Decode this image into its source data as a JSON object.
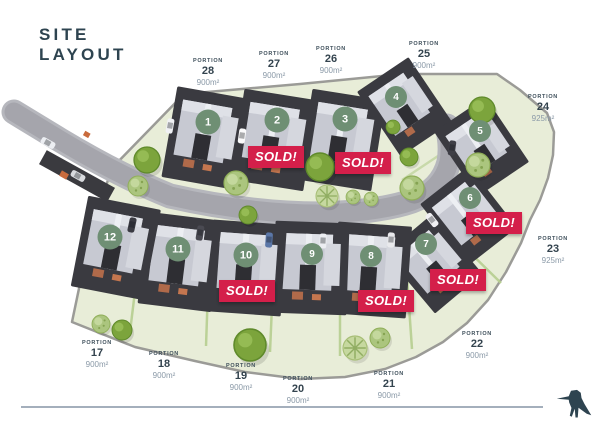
{
  "title": {
    "line1": "SITE",
    "line2": "LAYOUT"
  },
  "map": {
    "portions": [
      {
        "label": "PORTION",
        "number": "17",
        "area": "900m²"
      },
      {
        "label": "PORTION",
        "number": "18",
        "area": "900m²"
      },
      {
        "label": "PORTION",
        "number": "19",
        "area": "900m²"
      },
      {
        "label": "PORTION",
        "number": "20",
        "area": "900m²"
      },
      {
        "label": "PORTION",
        "number": "21",
        "area": "900m²"
      },
      {
        "label": "PORTION",
        "number": "22",
        "area": "900m²"
      },
      {
        "label": "PORTION",
        "number": "23",
        "area": "925m²"
      },
      {
        "label": "PORTION",
        "number": "24",
        "area": "925m²"
      },
      {
        "label": "PORTION",
        "number": "25",
        "area": "900m²"
      },
      {
        "label": "PORTION",
        "number": "26",
        "area": "900m²"
      },
      {
        "label": "PORTION",
        "number": "27",
        "area": "900m²"
      },
      {
        "label": "PORTION",
        "number": "28",
        "area": "900m²"
      }
    ],
    "houses": [
      {
        "number": "1"
      },
      {
        "number": "2"
      },
      {
        "number": "3"
      },
      {
        "number": "4"
      },
      {
        "number": "5"
      },
      {
        "number": "6"
      },
      {
        "number": "7"
      },
      {
        "number": "8"
      },
      {
        "number": "9"
      },
      {
        "number": "10"
      },
      {
        "number": "11"
      },
      {
        "number": "12"
      }
    ],
    "sold_banners": [
      {
        "text": "SOLD!"
      },
      {
        "text": "SOLD!"
      },
      {
        "text": "SOLD!"
      },
      {
        "text": "SOLD!"
      },
      {
        "text": "SOLD!"
      },
      {
        "text": "SOLD!"
      }
    ]
  },
  "colors": {
    "accent_red": "#d41f4a",
    "circle_green": "#6f8f74",
    "title_slate": "#2e4450",
    "ground_green": "#e8edd8",
    "road_gray": "#a5a5ac"
  }
}
